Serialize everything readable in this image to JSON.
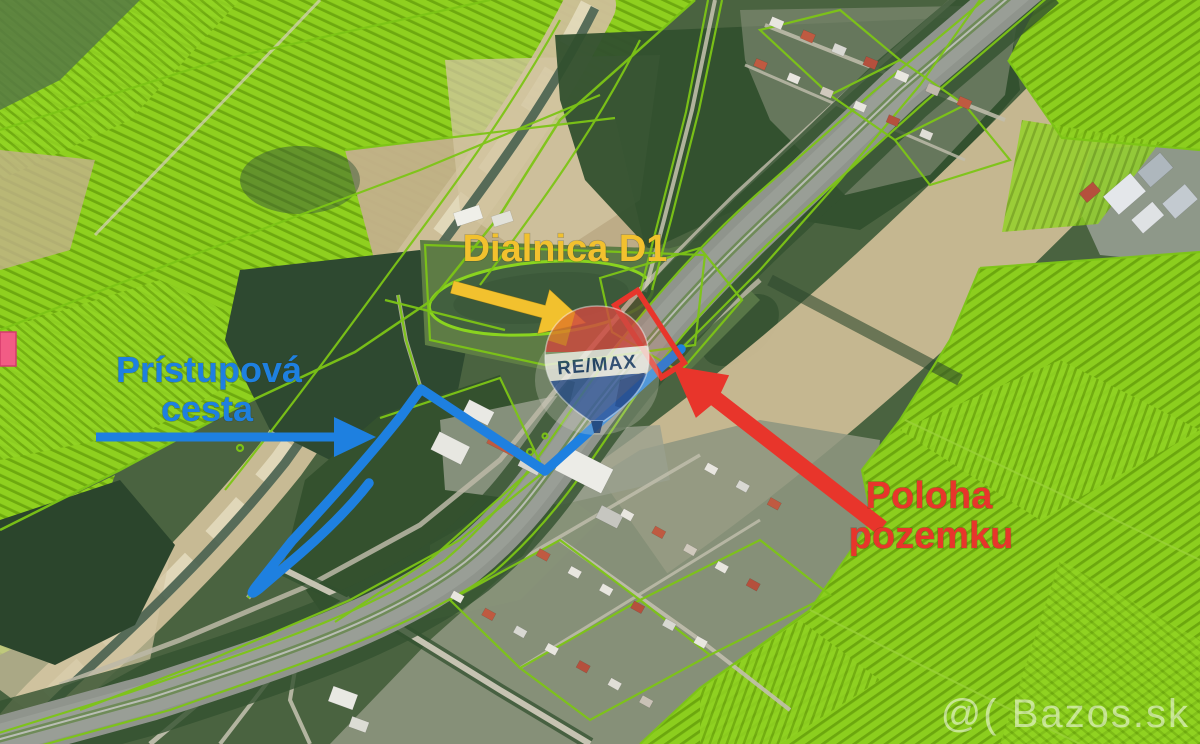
{
  "image": {
    "kind": "satellite-map-real-estate-annotation",
    "labels": {
      "highway": "Dialnica D1",
      "access_road_line1": "Prístupová",
      "access_road_line2": "cesta",
      "parcel_line1": "Poloha",
      "parcel_line2": "pozemku"
    },
    "logo": {
      "text": "RE/MAX"
    },
    "watermark": {
      "text": "@( Bazos.sk",
      "color": "#ffffff"
    },
    "colors": {
      "highway_label": "#f2c12e",
      "access_road": "#1e80e0",
      "parcel": "#e8352b",
      "cadastral": "#7dc516",
      "marker_pink": "#f25c85"
    }
  }
}
